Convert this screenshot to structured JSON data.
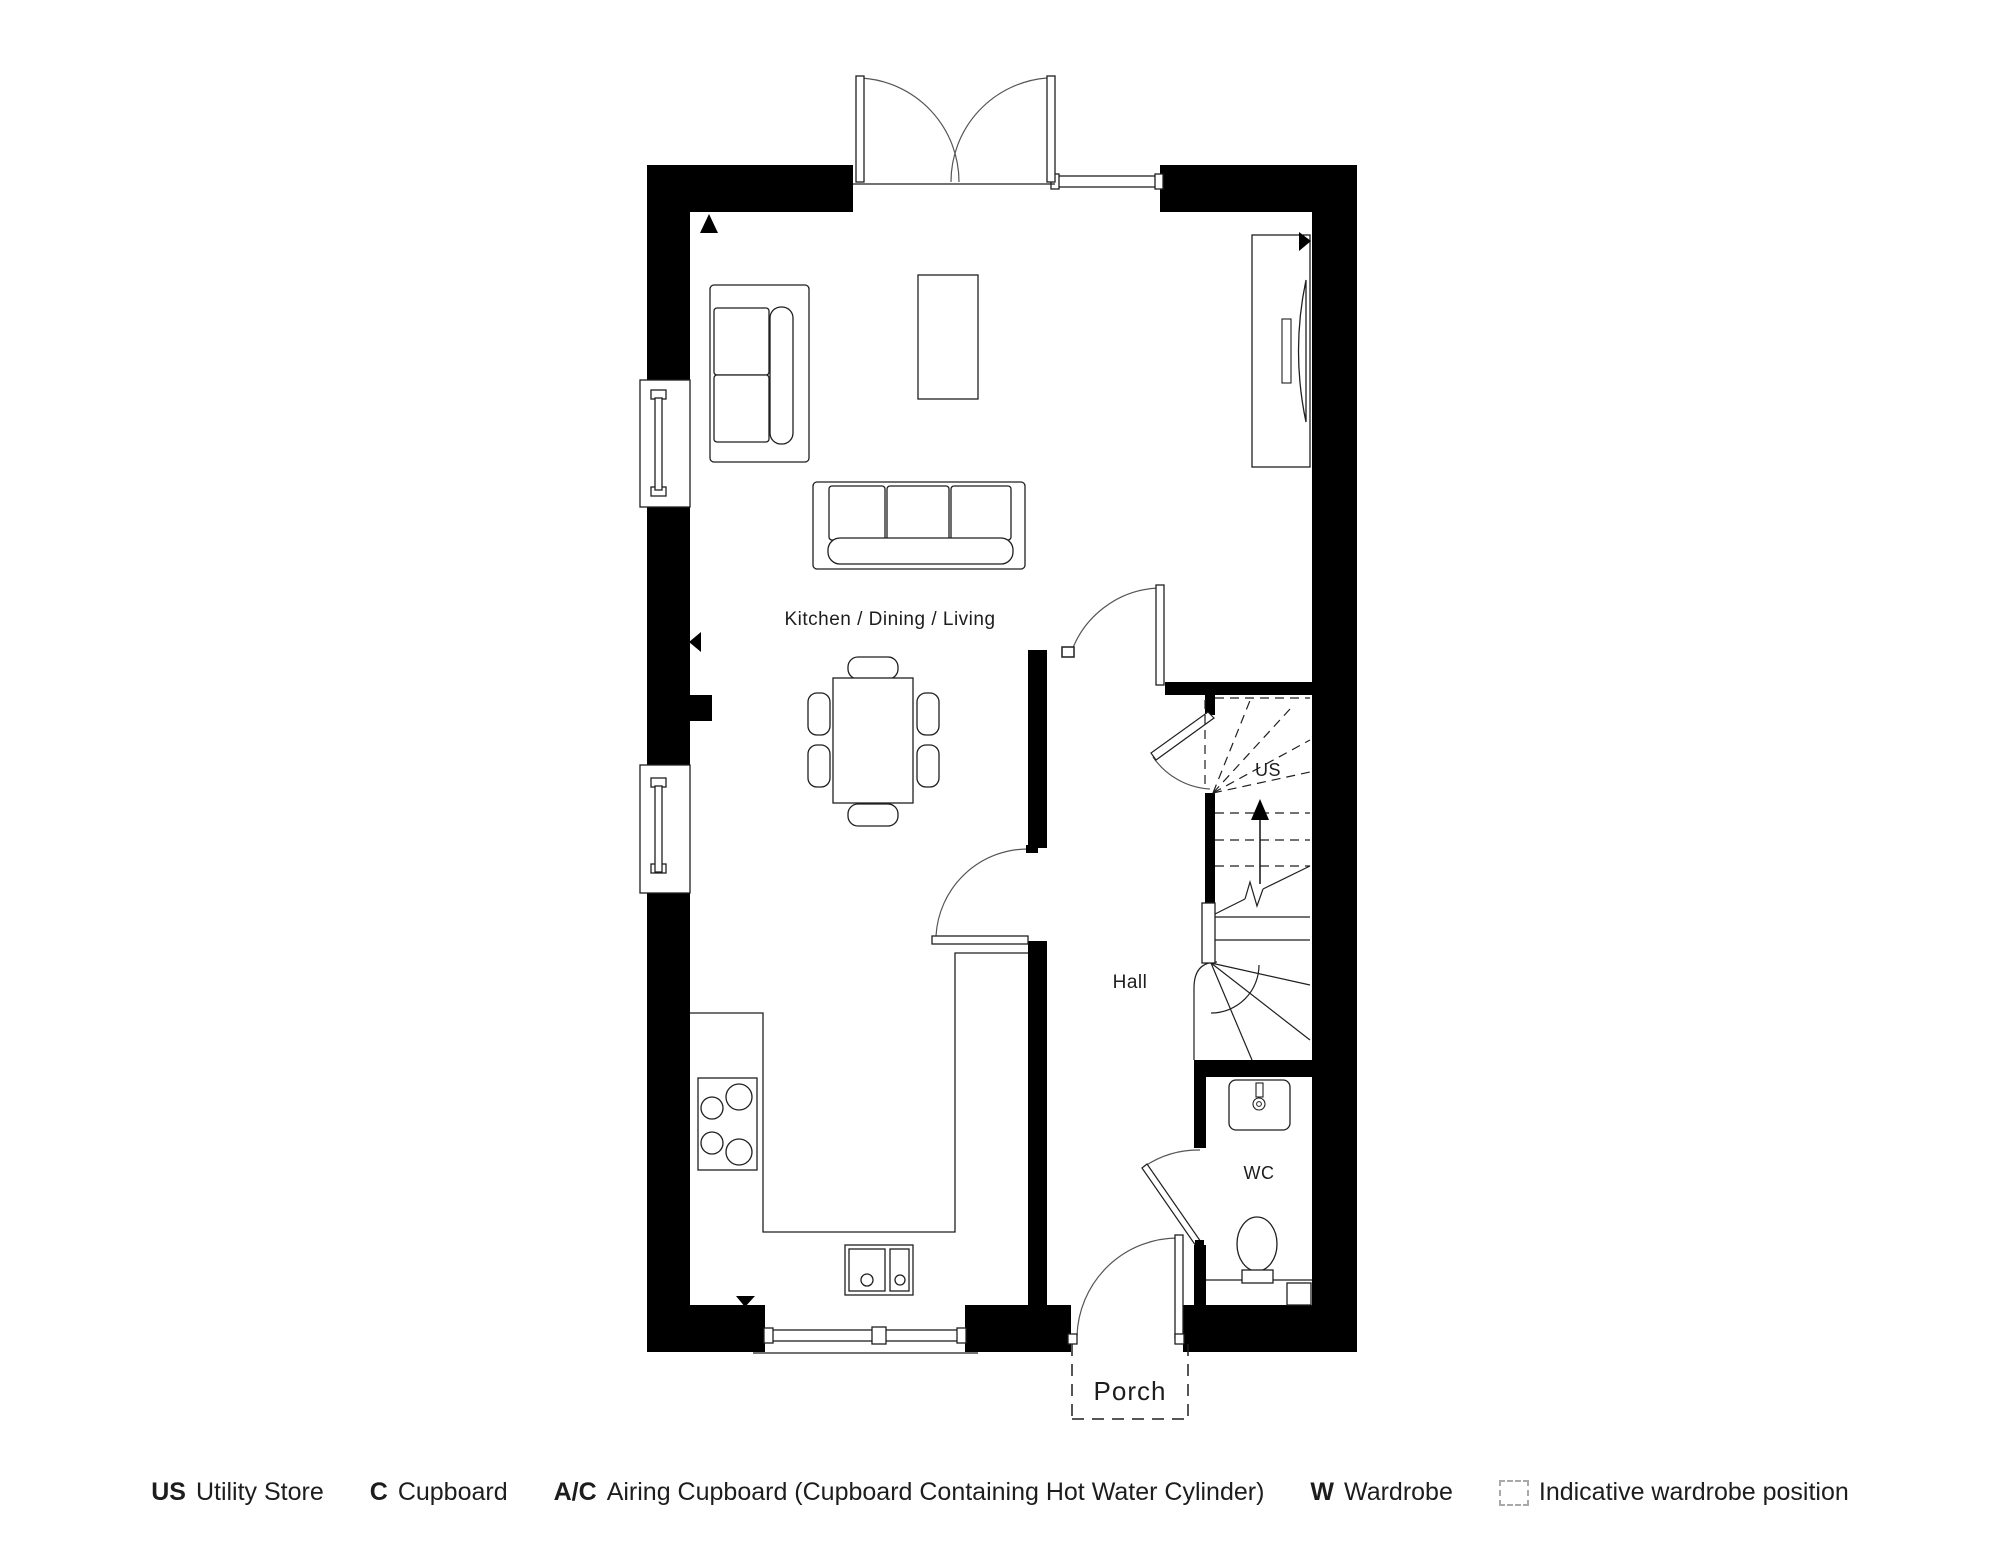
{
  "plan": {
    "rooms": {
      "kitchen_dining_living": "Kitchen / Dining / Living",
      "hall": "Hall",
      "us": "US",
      "wc": "WC",
      "porch": "Porch"
    },
    "stairs": {
      "direction_label": "up"
    },
    "colors": {
      "wall": "#000000",
      "line": "#1f1f1f",
      "thin_line": "#555555",
      "text": "#1d1d1d"
    }
  },
  "legend": {
    "items": [
      {
        "key": "US",
        "desc": "Utility Store"
      },
      {
        "key": "C",
        "desc": "Cupboard"
      },
      {
        "key": "A/C",
        "desc": "Airing Cupboard (Cupboard Containing Hot Water Cylinder)"
      },
      {
        "key": "W",
        "desc": "Wardrobe"
      },
      {
        "key": "",
        "desc": "Indicative wardrobe position"
      }
    ]
  }
}
